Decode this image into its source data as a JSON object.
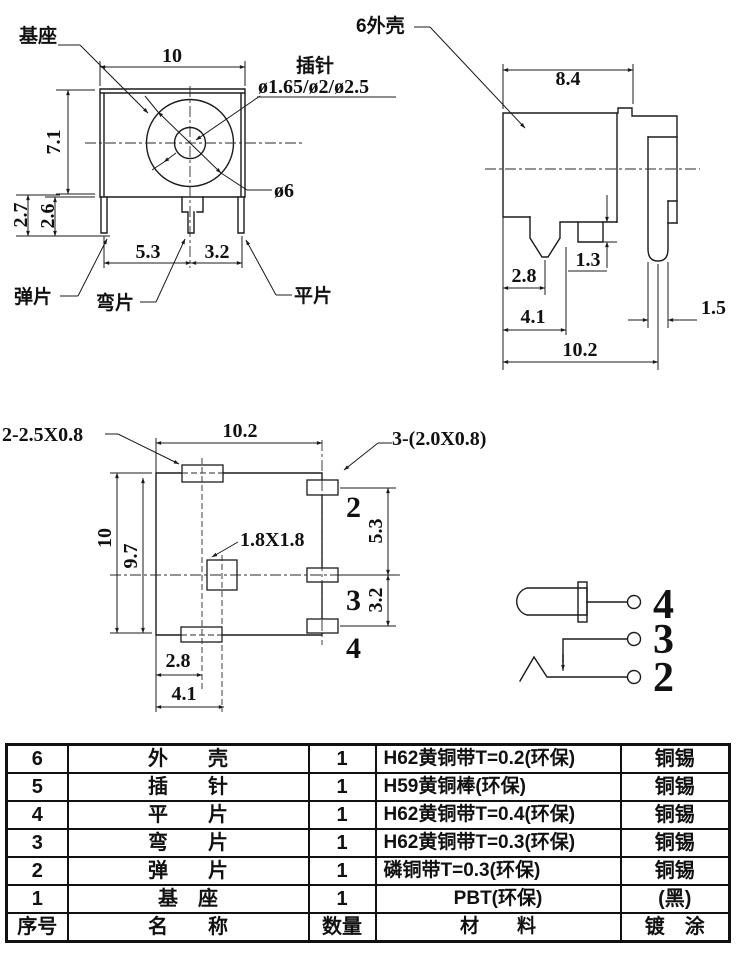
{
  "front": {
    "base": "基座",
    "pin": "插针",
    "pin_dia": "ø1.65/ø2/ø2.5",
    "dia6": "ø6",
    "spring": "弹片",
    "bend": "弯片",
    "flat": "平片",
    "w": "10",
    "h": "7.1",
    "d27": "2.7",
    "d26": "2.6",
    "d53": "5.3",
    "d32": "3.2"
  },
  "side": {
    "shell": "6外壳",
    "d84": "8.4",
    "d13": "1.3",
    "d28": "2.8",
    "d41": "4.1",
    "d15": "1.5",
    "d102": "10.2"
  },
  "bottom": {
    "pads_left": "2-2.5X0.8",
    "pads_right": "3-(2.0X0.8)",
    "square": "1.8X1.8",
    "d102": "10.2",
    "d10": "10",
    "d97": "9.7",
    "d53": "5.3",
    "d32": "3.2",
    "d28": "2.8",
    "d41": "4.1",
    "p2": "2",
    "p3": "3",
    "p4": "4"
  },
  "schematic": {
    "p4": "4",
    "p3": "3",
    "p2": "2"
  },
  "table": {
    "rows": [
      {
        "no": "6",
        "name": "外　　壳",
        "qty": "1",
        "material": "H62黄铜带T=0.2(环保)",
        "plating": "铜锡"
      },
      {
        "no": "5",
        "name": "插　　针",
        "qty": "1",
        "material": "H59黄铜棒(环保)",
        "plating": "铜锡"
      },
      {
        "no": "4",
        "name": "平　　片",
        "qty": "1",
        "material": "H62黄铜带T=0.4(环保)",
        "plating": "铜锡"
      },
      {
        "no": "3",
        "name": "弯　　片",
        "qty": "1",
        "material": "H62黄铜带T=0.3(环保)",
        "plating": "铜锡"
      },
      {
        "no": "2",
        "name": "弹　　片",
        "qty": "1",
        "material": "磷铜带T=0.3(环保)",
        "plating": "铜锡"
      },
      {
        "no": "1",
        "name": "基　座",
        "qty": "1",
        "material": "PBT(环保)",
        "plating": "(黑)"
      },
      {
        "no": "序号",
        "name": "名　　称",
        "qty": "数量",
        "material": "材　　料",
        "plating": "镀　涂"
      }
    ]
  }
}
